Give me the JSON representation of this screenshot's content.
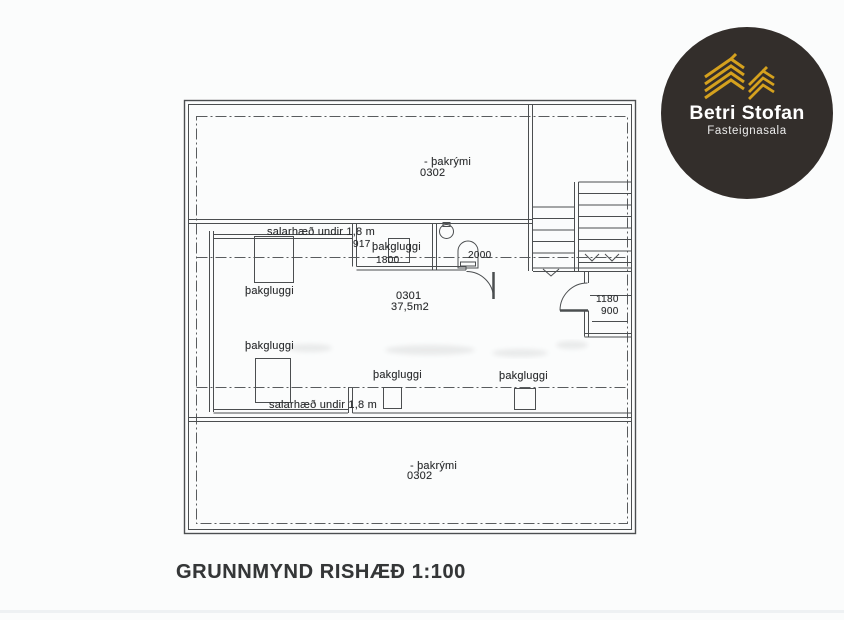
{
  "document": {
    "background": "#fbfcfc",
    "title": "GRUNNMYND RISHÆÐ 1:100"
  },
  "logo": {
    "brand": "Betri Stofan",
    "tagline": "Fasteignasala",
    "circle_color": "#332e2b",
    "gold_color": "#d5a11e",
    "icon": "gold-house-stack-icon"
  },
  "plan": {
    "attic_top": {
      "name": "- þakrými",
      "number": "0302"
    },
    "attic_bottom": {
      "name": "- þakrými",
      "number": "0302"
    },
    "main_room": {
      "number": "0301",
      "area": "37,5m2"
    },
    "ceiling_note_top": "salarhæð undir 1,8 m",
    "ceiling_note_bottom": "salarhæð undir 1,8 m",
    "skylights": {
      "left_top": "þakgluggi",
      "left_bottom": "þakgluggi",
      "dormer_top": "þakgluggi",
      "bottom_middle": "þakgluggi",
      "bottom_right": "þakgluggi"
    },
    "dimensions": {
      "skylight_height": "917",
      "skylight_length": "1800",
      "bathroom_length": "2000",
      "hall_width": "1180",
      "door_width": "900"
    }
  }
}
